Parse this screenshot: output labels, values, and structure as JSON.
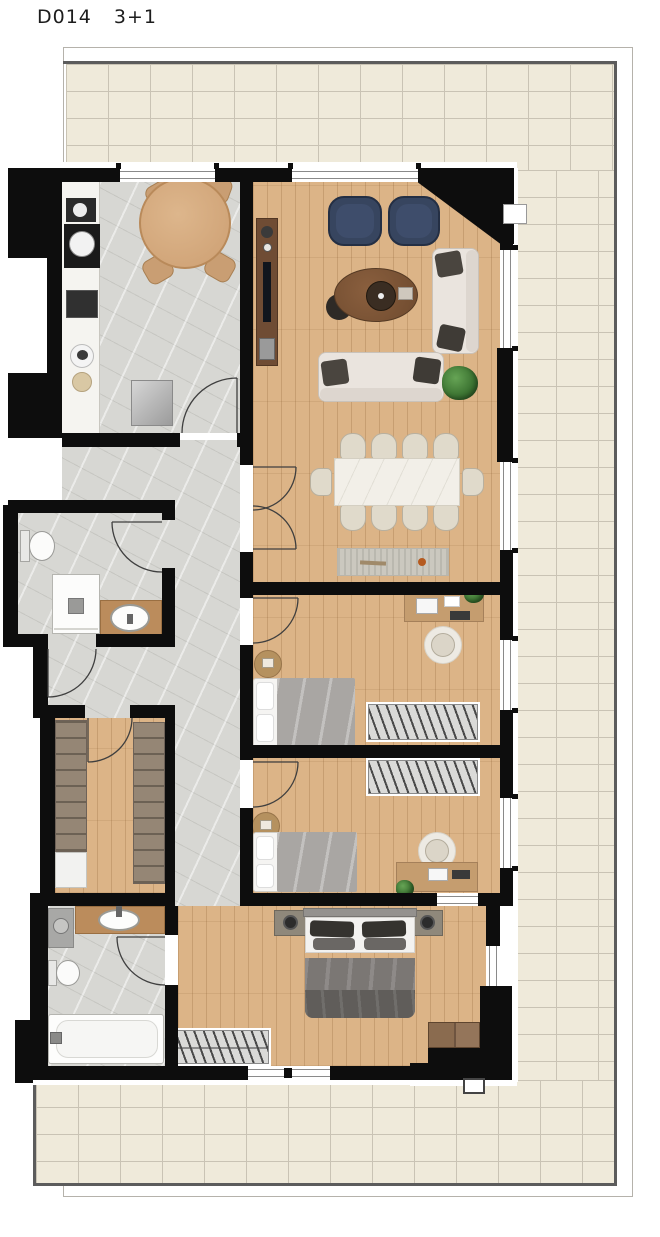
{
  "header": {
    "unit_code": "D014",
    "layout_type": "3+1"
  },
  "plan": {
    "palette": {
      "wall": "#0d0d0d",
      "wood_floor": "#dcb487",
      "marble_floor": "#d7d7d3",
      "terrace_tile": "#efeada",
      "tile_grout": "#c9c3b4",
      "sofa_fabric": "#eae4de",
      "armchair_navy": "#37455f",
      "round_table_wood": "#d2a57b",
      "console_wood": "#6f4c34",
      "counter_wood": "#bb8c5c",
      "duvet_gray": "#7b7774",
      "plant_green": "#3e7a37",
      "rug_gray": "#cbc8bf"
    },
    "rooms": [
      {
        "name": "terrace",
        "floor": "ceramic-tile"
      },
      {
        "name": "kitchen",
        "floor": "marble",
        "furniture": [
          "kitchen-counter",
          "coffee-machine",
          "sink",
          "cooktop",
          "round-dining-table",
          "four-chairs",
          "fridge"
        ]
      },
      {
        "name": "living-room",
        "floor": "wood",
        "furniture": [
          "tv-console",
          "two-navy-armchairs",
          "coffee-table",
          "side-table",
          "two-sofas",
          "plant",
          "dining-table-10-seats",
          "runner-rug"
        ]
      },
      {
        "name": "hallway",
        "floor": "marble"
      },
      {
        "name": "bathroom-1",
        "floor": "marble",
        "furniture": [
          "toilet",
          "shower",
          "washbasin-counter"
        ]
      },
      {
        "name": "walk-in-closet",
        "floor": "wood",
        "furniture": [
          "wardrobe-left",
          "wardrobe-right",
          "shelf-unit"
        ]
      },
      {
        "name": "bedroom-1",
        "floor": "wood",
        "furniture": [
          "single-bed",
          "desk",
          "chair",
          "wardrobe",
          "round-rug"
        ]
      },
      {
        "name": "bedroom-2",
        "floor": "wood",
        "furniture": [
          "single-bed",
          "desk",
          "chair",
          "wardrobe",
          "round-rug"
        ]
      },
      {
        "name": "master-bedroom",
        "floor": "wood",
        "furniture": [
          "double-bed",
          "two-nightstands",
          "two-lamps",
          "wardrobe",
          "dresser"
        ]
      },
      {
        "name": "bathroom-2",
        "floor": "marble",
        "furniture": [
          "washing-machine",
          "washbasin-counter",
          "toilet",
          "bathtub"
        ]
      }
    ]
  }
}
